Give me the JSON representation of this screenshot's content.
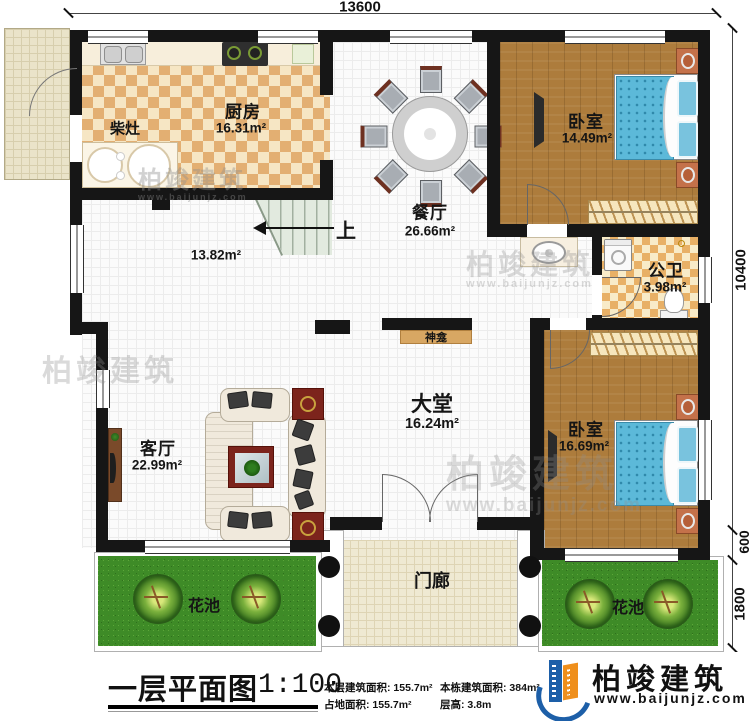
{
  "dimensions": {
    "top": "13600",
    "right_total": "10400",
    "right_wall": "600",
    "right_flowerbed": "1800"
  },
  "rooms": {
    "kitchen": {
      "name": "厨房",
      "area": "16.31m²"
    },
    "wood_stove": {
      "name": "柴灶"
    },
    "dining": {
      "name": "餐厅",
      "area": "26.66m²"
    },
    "stair_hall": {
      "area": "13.82m²"
    },
    "stairs": {
      "up": "上"
    },
    "bedroom_top": {
      "name": "卧室",
      "area": "14.49m²"
    },
    "bathroom": {
      "name": "公卫",
      "area": "3.98m²"
    },
    "bedroom_bottom": {
      "name": "卧室",
      "area": "16.69m²"
    },
    "hall": {
      "name": "大堂",
      "area": "16.24m²"
    },
    "shrine": {
      "name": "神龛"
    },
    "living": {
      "name": "客厅",
      "area": "22.99m²"
    },
    "porch": {
      "name": "门廊"
    },
    "flower_bed_left": {
      "name": "花池"
    },
    "flower_bed_right": {
      "name": "花池"
    }
  },
  "title_block": {
    "title": "一层平面图",
    "scale": "1:100",
    "stats": [
      {
        "label": "本层建筑面积:",
        "value": "155.7m²"
      },
      {
        "label": "占地面积:",
        "value": "155.7m²"
      },
      {
        "label": "本栋建筑面积:",
        "value": "384m²"
      },
      {
        "label": "层高:",
        "value": "3.8m"
      }
    ],
    "brand": {
      "name": "柏竣建筑",
      "url": "www.baijunjz.com"
    }
  },
  "watermarks": {
    "brand": "柏竣建筑",
    "url": "www.baijunjz.com"
  },
  "colors": {
    "wall": "#161616",
    "wood_floor": "#ad7c3c",
    "bed_blue": "#5cb9d9",
    "grass_green": "#3e8b27",
    "kitchen_tile": "#e3af72",
    "brand_blue": "#1d5fa8",
    "brand_orange": "#ef8f1c"
  }
}
